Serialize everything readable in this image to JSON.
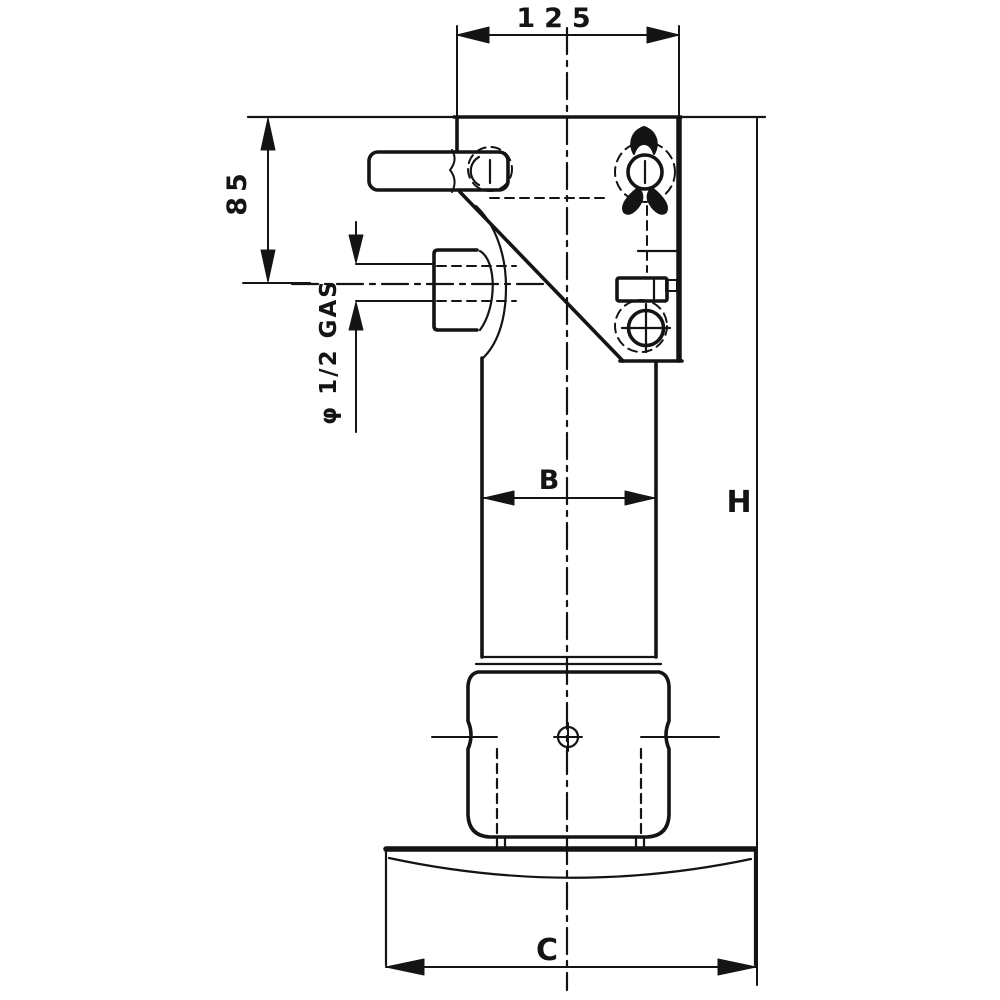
{
  "drawing": {
    "kind": "technical dimension drawing",
    "subject": "hydraulic bottle jack side elevation",
    "colors": {
      "ink": "#141414",
      "background": "#ffffff"
    },
    "labels": {
      "top_width": "125",
      "left_height": "85",
      "port_thread": "φ 1/2 GAS",
      "bore": "B",
      "total_height": "H",
      "base_width": "C"
    }
  }
}
